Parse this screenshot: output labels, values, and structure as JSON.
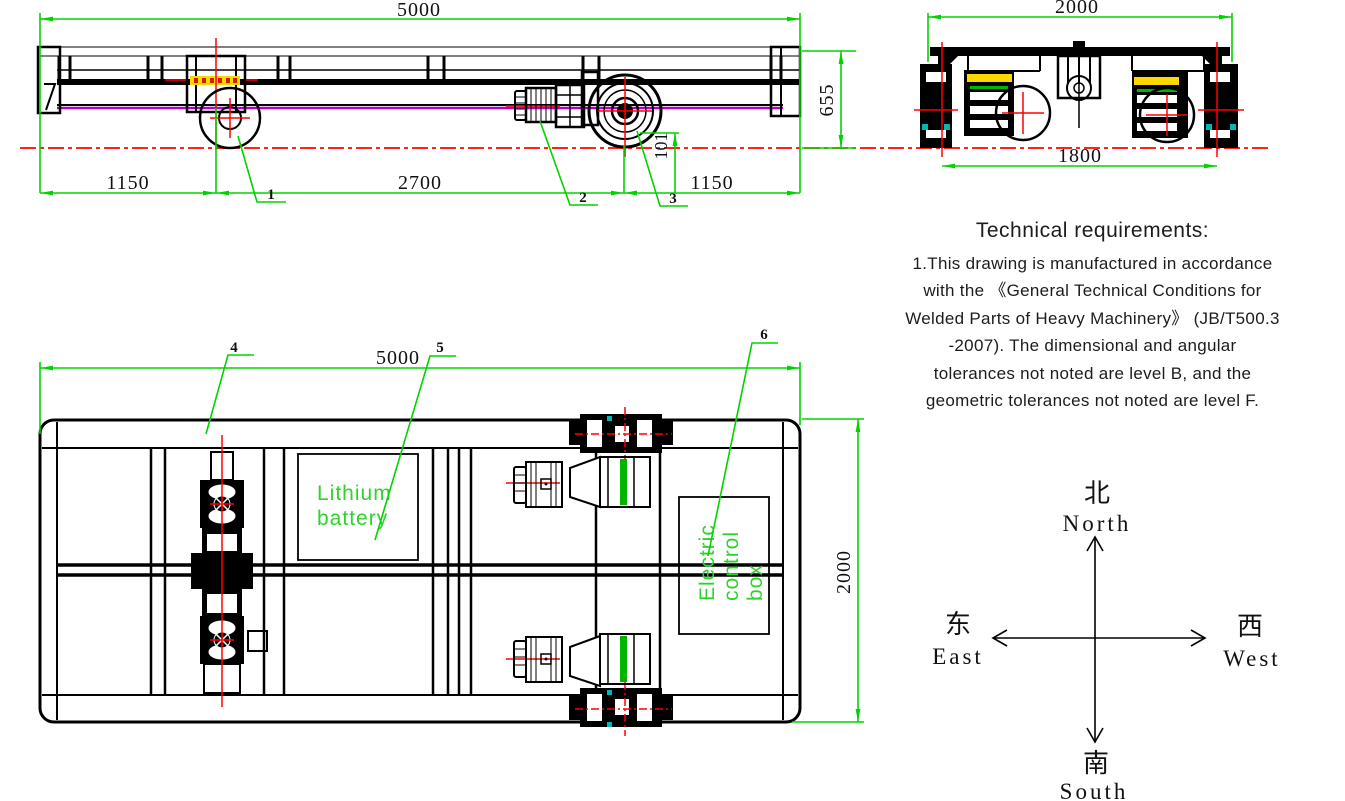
{
  "colors": {
    "dimension_green": "#00d400",
    "label_text_green": "#2ed32e",
    "centerline_red": "#ff0000",
    "frame_purple": "#b400c8",
    "label_yellow": "#ffd700",
    "accent_cyan": "#00b8b8",
    "drawing_black": "#000000"
  },
  "side_view": {
    "dim_total_length": "5000",
    "dim_left_overhang": "1150",
    "dim_wheelbase": "2700",
    "dim_right_overhang": "1150",
    "dim_frame_height": "655",
    "dim_flange_height": "101",
    "callout_1": "1",
    "callout_2": "2",
    "callout_3": "3"
  },
  "end_view": {
    "dim_overall_width": "2000",
    "dim_wheel_gauge": "1800"
  },
  "top_view": {
    "dim_length": "5000",
    "dim_width": "2000",
    "callout_4": "4",
    "callout_5": "5",
    "callout_6": "6",
    "battery_label_line1": "Lithium",
    "battery_label_line2": "battery",
    "control_box_line1": "Electric",
    "control_box_line2": "control",
    "control_box_line3": "box"
  },
  "technical_requirements": {
    "title": "Technical requirements:",
    "lines": [
      "1.This drawing is manufactured in accordance",
      "with the 《General Technical Conditions for",
      "Welded Parts of Heavy Machinery》 (JB/T500.3",
      "-2007). The dimensional and angular",
      "tolerances not noted are level B, and the",
      "geometric tolerances not noted are level F."
    ]
  },
  "compass": {
    "north_cn": "北",
    "north_en": "North",
    "south_cn": "南",
    "south_en": "South",
    "east_cn": "东",
    "east_en": "East",
    "west_cn": "西",
    "west_en": "West"
  }
}
